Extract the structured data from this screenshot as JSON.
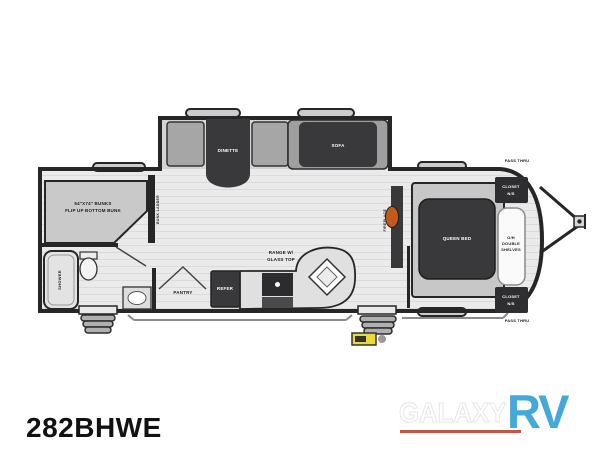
{
  "model": "282BHWE",
  "watermark": {
    "brand": "GALAXY",
    "type": "RV"
  },
  "colors": {
    "wall": "#262626",
    "floor": "#eaeaea",
    "slide-floor": "#d4d4d4",
    "furniture-dark": "#39393b",
    "furniture-mid": "#a6a6a6",
    "platform": "#c7c7c7",
    "fireplace-orange": "#c25a1e",
    "badge-yellow": "#e9d93c",
    "logo-blue": "#45a8da",
    "logo-underline": "#c05747",
    "label-dark": "#1c1c1c"
  },
  "labels": {
    "dinette": "DINETTE",
    "sofa": "SOFA",
    "bunks_line1": "54\"X74\" BUNKS",
    "bunks_line2": "FLIP UP BOTTOM BUNK",
    "bunk_ladder": "BUNK LADDER",
    "shower": "SHOWER",
    "pantry": "PANTRY",
    "refer": "REFER",
    "range_line1": "RANGE W/",
    "range_line2": "GLASS TOP",
    "fireplace": "FIREPLACE",
    "queen_bed": "QUEEN BED",
    "closet_top_line1": "CLOSET",
    "closet_top_line2": "N/S",
    "shelves_line1": "O/H",
    "shelves_line2": "DOUBLE",
    "shelves_line3": "SHELVES",
    "closet_bottom_line1": "CLOSET",
    "closet_bottom_line2": "N/S",
    "pass_thru_top": "PASS THRU",
    "pass_thru_bottom": "PASS THRU"
  }
}
